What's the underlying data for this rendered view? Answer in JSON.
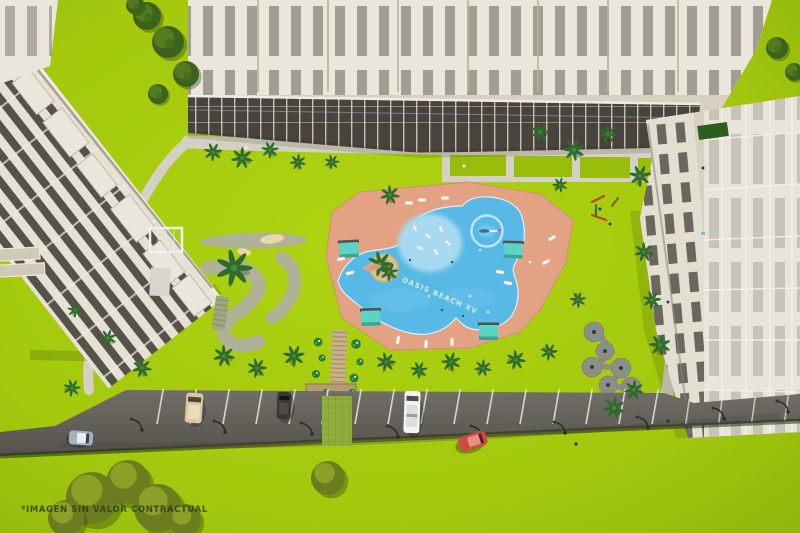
{
  "watermark": {
    "text": "*IMAGEN SIN VALOR CONTRACTUAL"
  },
  "pool": {
    "label": "OASIS BEACH XV"
  },
  "palette": {
    "lawn": "#a5c90f",
    "lawn_deep": "#99bd0b",
    "foliage_dark": "#3f611d",
    "foliage_olive": "#6b7d1e",
    "path": "#d4d0c6",
    "building_light": "#eae6db",
    "building_mid": "#d8d1c2",
    "building_dark": "#49453e",
    "deck": "#e2a283",
    "pool": "#58b9e6",
    "pool_shallow": "#a7daf1",
    "pool_edge": "#dbf2fb",
    "cabana": "#5dd3c6",
    "asphalt": "#67645e",
    "sand": "#ead9a4",
    "golf_path": "#afb294",
    "picnic_grey": "#8f8d85",
    "bench_teal": "#2fb7a6",
    "wood": "#c4a87e",
    "watermark_color": "#2c3a0d",
    "pool_label_color": "#ddf1fb"
  },
  "scene": {
    "buildings": [
      "top-apartment-block",
      "left-apartment-block",
      "right-apartment-block"
    ],
    "amenities": [
      "lagoon-pool",
      "pool-deck",
      "palm-island",
      "swim-ring",
      "cabanas",
      "mini-golf",
      "pergola",
      "boardwalk",
      "picnic-circles",
      "playground",
      "parking-lot"
    ],
    "vehicles": [
      {
        "name": "parked-van-tan",
        "color": "#d8c79e"
      },
      {
        "name": "parked-suv-dark",
        "color": "#3a3936"
      },
      {
        "name": "parked-van-white",
        "color": "#f4f3f0"
      },
      {
        "name": "parked-car-red",
        "color": "#cd4a40"
      },
      {
        "name": "driving-car-silver",
        "color": "#a4b2bd"
      }
    ]
  }
}
